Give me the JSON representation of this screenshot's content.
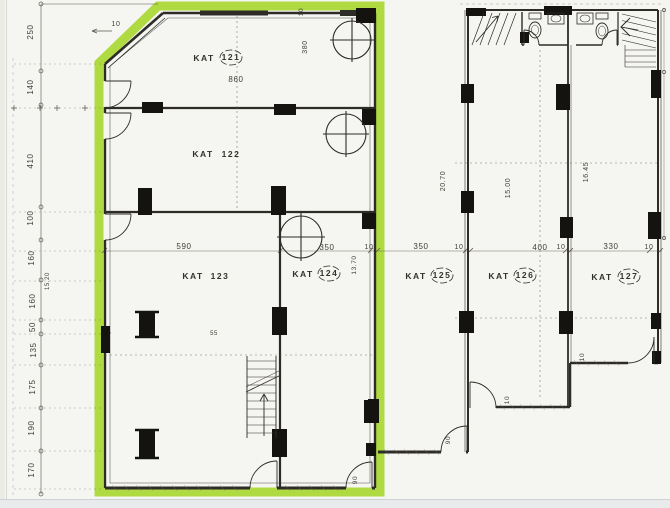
{
  "drawing": {
    "kind": "scanned architectural floor plan",
    "highlight_color": "#a8d733",
    "paper_color": "#f5f5f1",
    "ink_color": "#2e2c27"
  },
  "rooms": [
    {
      "name": "KAT",
      "number": "121",
      "name_x": 204,
      "name_y": 61,
      "num_x": 231,
      "num_y": 60,
      "circled": true
    },
    {
      "name": "KAT",
      "number": "122",
      "name_x": 203,
      "name_y": 157,
      "num_x": 231,
      "num_y": 157,
      "circled": false
    },
    {
      "name": "KAT",
      "number": "123",
      "name_x": 193,
      "name_y": 279,
      "num_x": 220,
      "num_y": 279,
      "circled": false
    },
    {
      "name": "KAT",
      "number": "124",
      "name_x": 303,
      "name_y": 277,
      "num_x": 329,
      "num_y": 276,
      "circled": true
    },
    {
      "name": "KAT",
      "number": "125",
      "name_x": 416,
      "name_y": 279,
      "num_x": 442,
      "num_y": 278,
      "circled": true
    },
    {
      "name": "KAT",
      "number": "126",
      "name_x": 499,
      "name_y": 279,
      "num_x": 525,
      "num_y": 278,
      "circled": true
    },
    {
      "name": "KAT",
      "number": "127",
      "name_x": 602,
      "name_y": 280,
      "num_x": 629,
      "num_y": 279,
      "circled": true
    }
  ],
  "dimensions": [
    {
      "text": "250",
      "x": 33,
      "y": 32,
      "rot": -90,
      "size": 8
    },
    {
      "text": "140",
      "x": 33,
      "y": 87,
      "rot": -90,
      "size": 8
    },
    {
      "text": "410",
      "x": 33,
      "y": 161,
      "rot": -90,
      "size": 8
    },
    {
      "text": "100",
      "x": 33,
      "y": 218,
      "rot": -90,
      "size": 8
    },
    {
      "text": "160",
      "x": 34,
      "y": 258,
      "rot": -90,
      "size": 8
    },
    {
      "text": "15.20",
      "x": 49,
      "y": 281,
      "rot": -90,
      "size": 6
    },
    {
      "text": "160",
      "x": 35,
      "y": 301,
      "rot": -90,
      "size": 8
    },
    {
      "text": "50",
      "x": 35,
      "y": 327,
      "rot": -90,
      "size": 8
    },
    {
      "text": "135",
      "x": 36,
      "y": 350,
      "rot": -90,
      "size": 8
    },
    {
      "text": "175",
      "x": 35,
      "y": 387,
      "rot": -90,
      "size": 8
    },
    {
      "text": "190",
      "x": 34,
      "y": 428,
      "rot": -90,
      "size": 8
    },
    {
      "text": "170",
      "x": 34,
      "y": 470,
      "rot": -90,
      "size": 8
    },
    {
      "text": "10",
      "x": 116,
      "y": 26,
      "rot": 0,
      "size": 7
    },
    {
      "text": "860",
      "x": 236,
      "y": 82,
      "rot": 0,
      "size": 8
    },
    {
      "text": "380",
      "x": 307,
      "y": 47,
      "rot": -90,
      "size": 7
    },
    {
      "text": "10",
      "x": 303,
      "y": 12,
      "rot": -90,
      "size": 6.5
    },
    {
      "text": "590",
      "x": 184,
      "y": 249,
      "rot": 0,
      "size": 8
    },
    {
      "text": "350",
      "x": 327,
      "y": 250,
      "rot": 0,
      "size": 8
    },
    {
      "text": "10",
      "x": 369,
      "y": 249,
      "rot": 0,
      "size": 7
    },
    {
      "text": "13.70",
      "x": 356,
      "y": 265,
      "rot": -90,
      "size": 6.5
    },
    {
      "text": "350",
      "x": 421,
      "y": 249,
      "rot": 0,
      "size": 8
    },
    {
      "text": "10",
      "x": 459,
      "y": 249,
      "rot": 0,
      "size": 7
    },
    {
      "text": "400",
      "x": 540,
      "y": 250,
      "rot": 0,
      "size": 8
    },
    {
      "text": "10",
      "x": 561,
      "y": 249,
      "rot": 0,
      "size": 7
    },
    {
      "text": "330",
      "x": 611,
      "y": 249,
      "rot": 0,
      "size": 8
    },
    {
      "text": "10",
      "x": 649,
      "y": 249,
      "rot": 0,
      "size": 7
    },
    {
      "text": "20.70",
      "x": 445,
      "y": 181,
      "rot": -90,
      "size": 7
    },
    {
      "text": "15.00",
      "x": 510,
      "y": 188,
      "rot": -90,
      "size": 7
    },
    {
      "text": "16.45",
      "x": 588,
      "y": 172,
      "rot": -90,
      "size": 7
    },
    {
      "text": "10",
      "x": 509,
      "y": 400,
      "rot": -90,
      "size": 6.5
    },
    {
      "text": "10",
      "x": 584,
      "y": 357,
      "rot": -90,
      "size": 6.5
    },
    {
      "text": "90",
      "x": 357,
      "y": 480,
      "rot": -90,
      "size": 6.5
    },
    {
      "text": "90",
      "x": 450,
      "y": 440,
      "rot": -90,
      "size": 6.5
    },
    {
      "text": "55",
      "x": 214,
      "y": 335,
      "rot": 0,
      "size": 6
    }
  ],
  "symbols": {
    "column_filled": "black rectangle",
    "column_round": "circle with cross",
    "door": "quarter-circle arc",
    "stairs": "hatched step lines with arrow",
    "toilet": "ellipse with tank",
    "sink": "rectangle with oval basin"
  }
}
